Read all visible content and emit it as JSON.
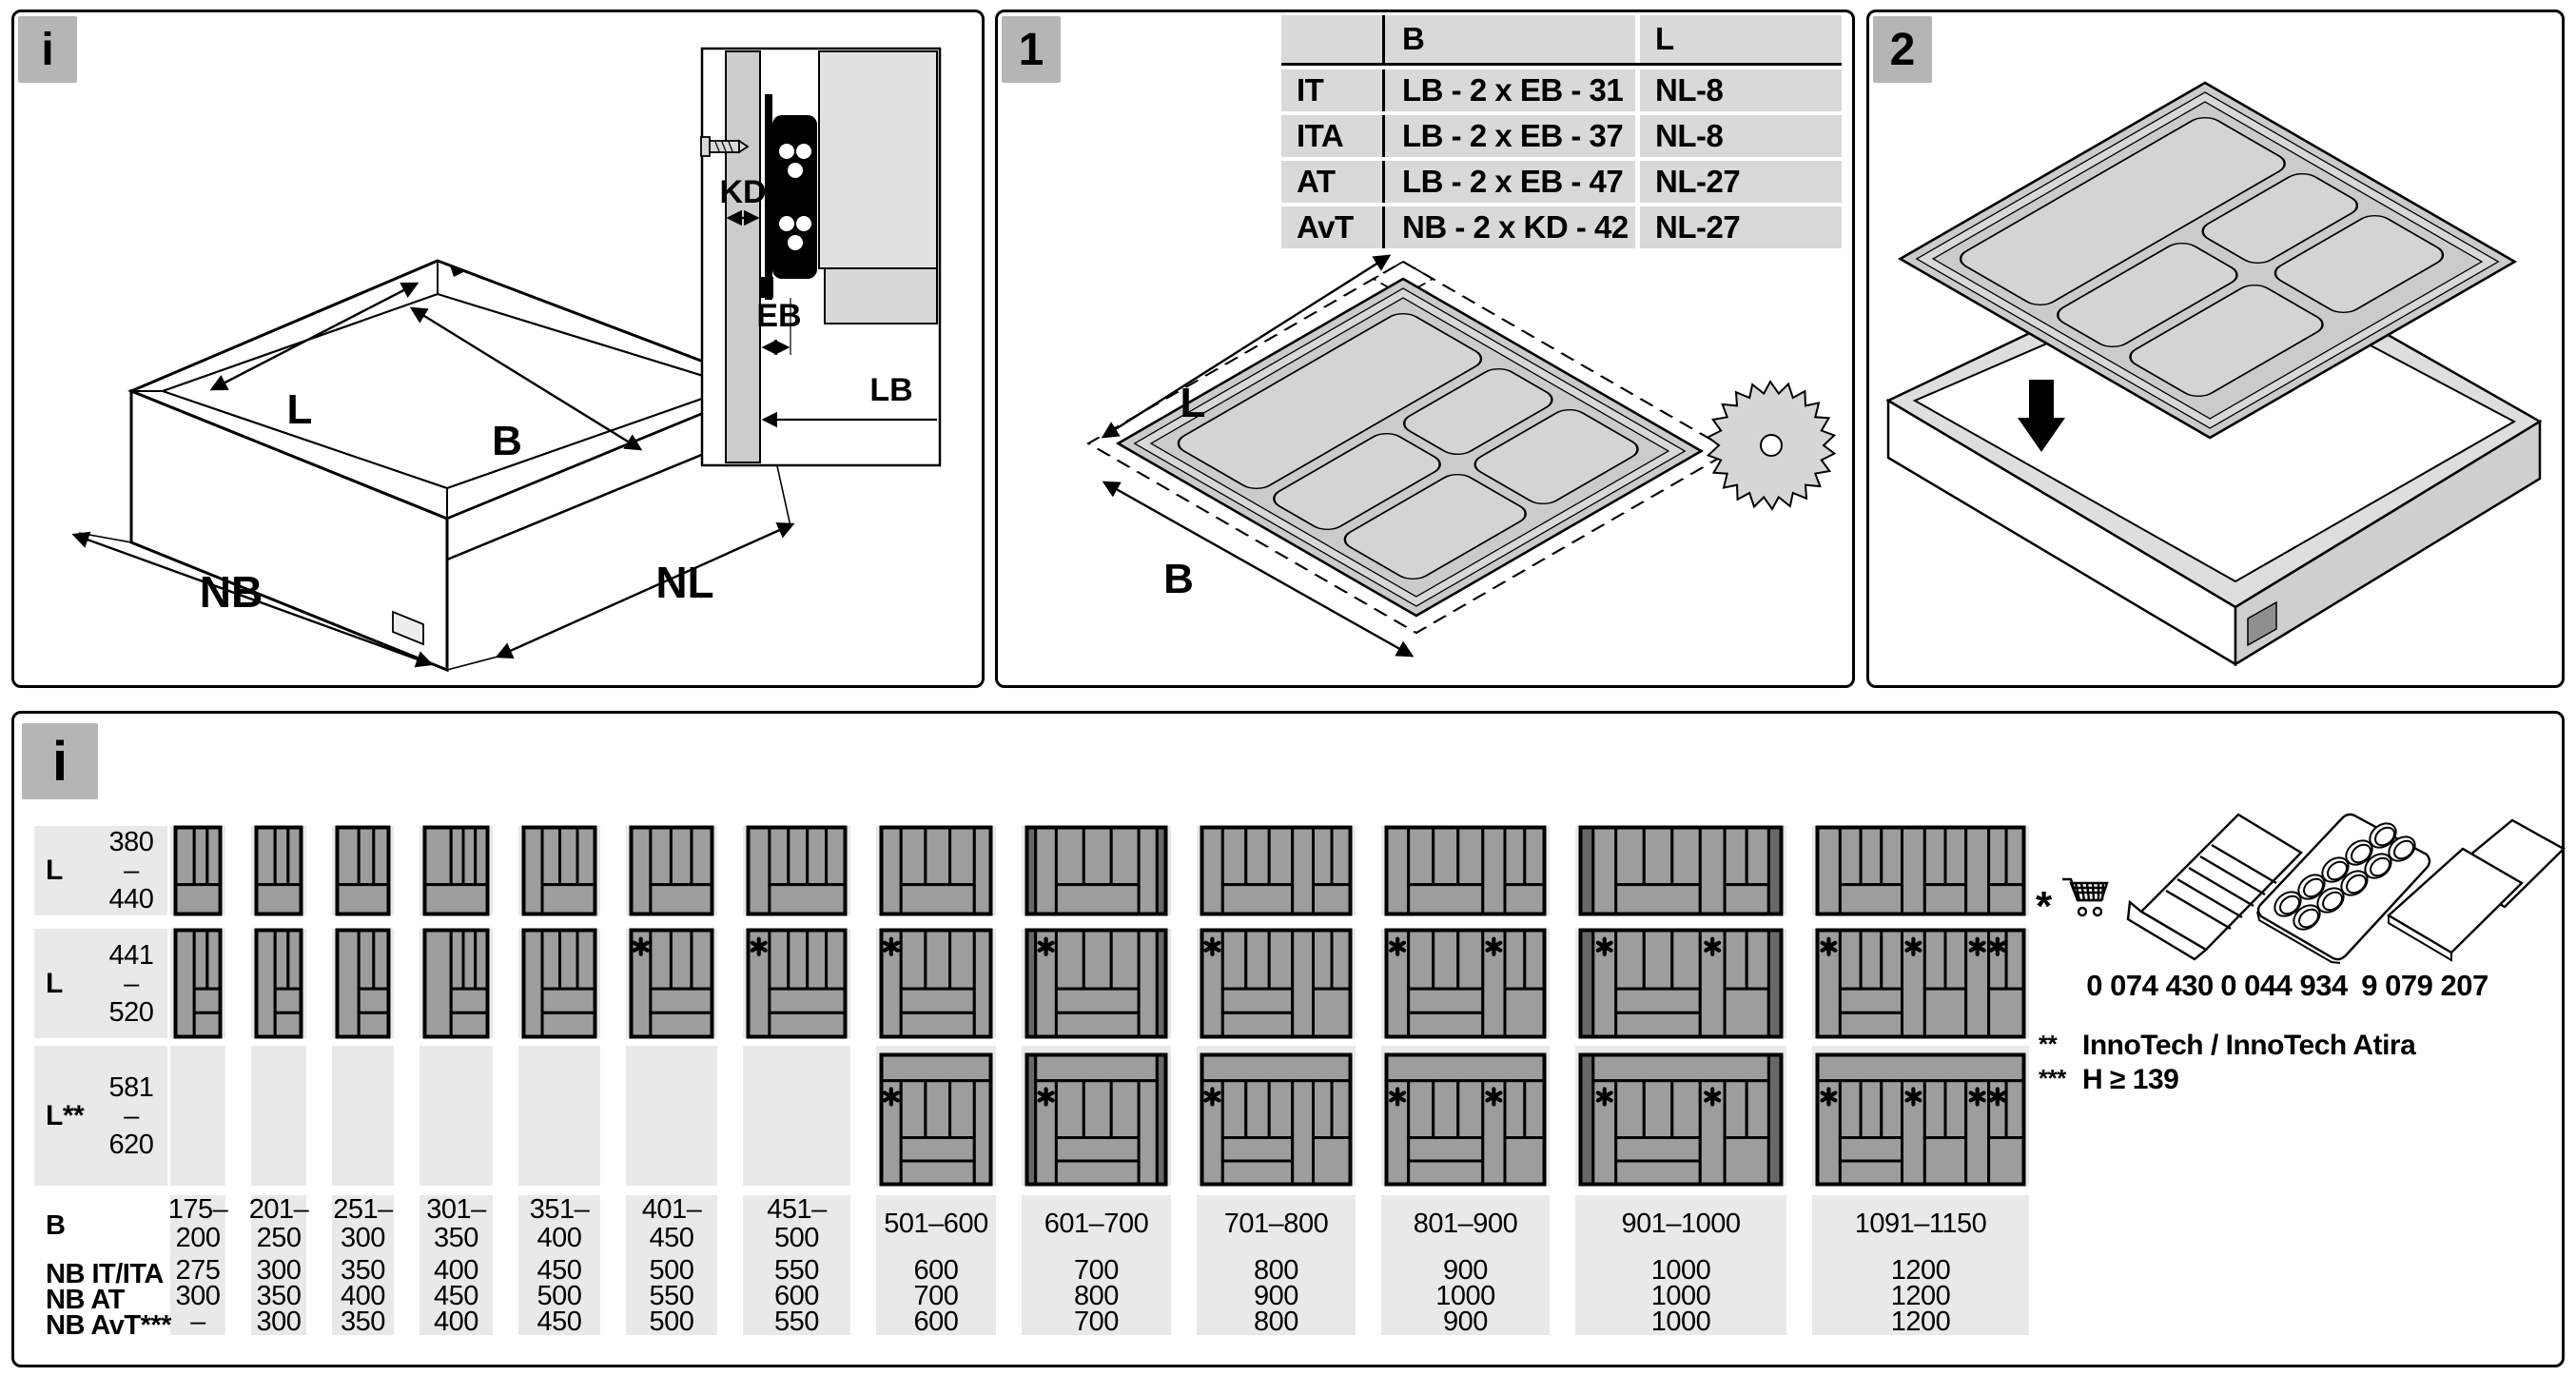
{
  "colors": {
    "badge_bg": "#b5b5b5",
    "table_cell_bg": "#d9d9d9",
    "stripe_bg": "#e9e9e9",
    "icon_fill": "#9d9d9d",
    "icon_dark": "#686868",
    "tray_fill": "#cbcbcb",
    "line": "#000000"
  },
  "top_info": {
    "badge": "i",
    "drawer_labels": {
      "l": "L",
      "b": "B",
      "h": "H",
      "nb": "NB",
      "nl": "NL"
    },
    "inset_labels": {
      "kd": "KD",
      "eb": "EB",
      "lb": "LB"
    }
  },
  "step1": {
    "badge": "1",
    "labels": {
      "l": "L",
      "b": "B"
    },
    "table": {
      "col_headers": {
        "b": "B",
        "l": "L"
      },
      "rows": [
        {
          "label": "IT",
          "b": "LB - 2 x EB - 31",
          "l": "NL-8"
        },
        {
          "label": "ITA",
          "b": "LB - 2 x EB - 37",
          "l": "NL-8"
        },
        {
          "label": "AT",
          "b": "LB - 2 x EB - 47",
          "l": "NL-27"
        },
        {
          "label": "AvT",
          "b": "NB - 2 x KD - 42",
          "l": "NL-27"
        }
      ]
    }
  },
  "step2": {
    "badge": "2"
  },
  "matrix": {
    "badge": "i",
    "row_groups": [
      {
        "label": "L",
        "range": [
          "380",
          "–",
          "440"
        ]
      },
      {
        "label": "L",
        "range": [
          "441",
          "–",
          "520"
        ]
      },
      {
        "label": "L**",
        "range": [
          "581",
          "–",
          "620"
        ]
      }
    ],
    "b_row_label": "B",
    "nb_row_labels": [
      "NB IT/ITA",
      "NB AT",
      "NB AvT***"
    ],
    "columns": [
      {
        "b": [
          "175–",
          "200"
        ],
        "nb": [
          "275",
          "300",
          "–"
        ],
        "stars_r2": 0,
        "stars_r3": 0,
        "has_r3": false,
        "tray": {
          "tc": 3,
          "fw": 1
        }
      },
      {
        "b": [
          "201–",
          "250"
        ],
        "nb": [
          "300",
          "350",
          "300"
        ],
        "stars_r2": 0,
        "stars_r3": 0,
        "has_r3": false,
        "tray": {
          "tc": 3,
          "fw": 1
        }
      },
      {
        "b": [
          "251–",
          "300"
        ],
        "nb": [
          "350",
          "400",
          "350"
        ],
        "stars_r2": 0,
        "stars_r3": 0,
        "has_r3": false,
        "tray": {
          "tc": 3,
          "fw": 1
        }
      },
      {
        "b": [
          "301–",
          "350"
        ],
        "nb": [
          "400",
          "450",
          "400"
        ],
        "stars_r2": 0,
        "stars_r3": 0,
        "has_r3": false,
        "tray": {
          "tc": 4,
          "fw": 1
        }
      },
      {
        "b": [
          "351–",
          "400"
        ],
        "nb": [
          "450",
          "500",
          "450"
        ],
        "stars_r2": 0,
        "stars_r3": 0,
        "has_r3": false,
        "tray": {
          "lt": 1,
          "ltf": 0.26,
          "tc": 3
        }
      },
      {
        "b": [
          "401–",
          "450"
        ],
        "nb": [
          "500",
          "550",
          "500"
        ],
        "stars_r2": 1,
        "stars_r3": 0,
        "has_r3": false,
        "tray": {
          "lt": 1,
          "ltf": 0.24,
          "tc": 3
        }
      },
      {
        "b": [
          "451–",
          "500"
        ],
        "nb": [
          "550",
          "600",
          "550"
        ],
        "stars_r2": 1,
        "stars_r3": 0,
        "has_r3": false,
        "tray": {
          "lt": 1,
          "ltf": 0.22,
          "tc": 4
        }
      },
      {
        "b": [
          "501–600"
        ],
        "nb": [
          "600",
          "700",
          "600"
        ],
        "stars_r2": 1,
        "stars_r3": 1,
        "has_r3": true,
        "tray": {
          "lt": 1,
          "ltf": 0.18,
          "tc": 3,
          "rt": 1
        }
      },
      {
        "b": [
          "601–700"
        ],
        "nb": [
          "700",
          "800",
          "700"
        ],
        "stars_r2": 1,
        "stars_r3": 1,
        "has_r3": true,
        "tray": {
          "lt": 1,
          "ltf": 0.17,
          "tc": 3,
          "rt": 1,
          "dark": 1
        }
      },
      {
        "b": [
          "701–800"
        ],
        "nb": [
          "800",
          "900",
          "800"
        ],
        "stars_r2": 1,
        "stars_r3": 1,
        "has_r3": true,
        "tray": {
          "lt": 1,
          "ltf": 0.14,
          "tc": 3,
          "ct": 1,
          "rc": 2
        }
      },
      {
        "b": [
          "801–900"
        ],
        "nb": [
          "900",
          "1000",
          "900"
        ],
        "stars_r2": 2,
        "stars_r3": 2,
        "has_r3": true,
        "tray": {
          "lt": 1,
          "ltf": 0.14,
          "tc": 3,
          "ct": 1,
          "rc": 2
        }
      },
      {
        "b": [
          "901–1000"
        ],
        "nb": [
          "1000",
          "1000",
          "1000"
        ],
        "stars_r2": 2,
        "stars_r3": 2,
        "has_r3": true,
        "tray": {
          "lt": 1,
          "ltf": 0.13,
          "tc": 3,
          "ct": 1,
          "rc": 2,
          "dark": 1
        }
      },
      {
        "b": [
          "1091–1150"
        ],
        "nb": [
          "1200",
          "1200",
          "1200"
        ],
        "stars_r2": 4,
        "stars_r3": 4,
        "has_r3": true,
        "tray": {
          "lt": 1,
          "ltf": 0.11,
          "tc": 3,
          "ct": 1,
          "ctf": 0.11,
          "rc": 2,
          "g2f": 0.2,
          "rt": 1,
          "rtf": 0.11,
          "fc": 2
        }
      }
    ],
    "legend": {
      "star": "*",
      "part_numbers": [
        "0 074 430",
        "0 044 934",
        "9 079 207"
      ],
      "notes": [
        {
          "mark": "**",
          "text": "InnoTech  / InnoTech Atira"
        },
        {
          "mark": "***",
          "text": "H ≥ 139"
        }
      ]
    }
  }
}
